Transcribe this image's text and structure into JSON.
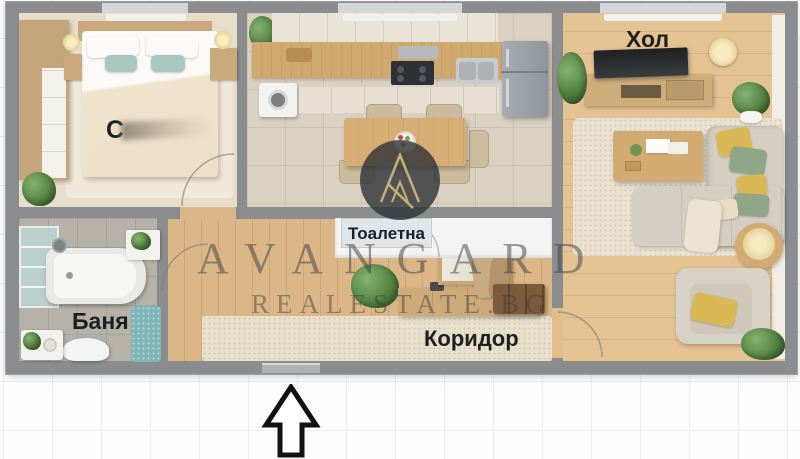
{
  "floorplan": {
    "rooms": {
      "bedroom_label": "С",
      "living_label": "Хол",
      "toilet_label": "Тоалетна",
      "bathroom_label": "Баня",
      "corridor_label": "Коридор"
    },
    "watermark": {
      "brand": "AVANGARD",
      "site": "REALESTATE.BG"
    },
    "colors": {
      "wall_gray": "#8b8c8e",
      "corridor_wood": "#dbb687",
      "living_wood": "#e5c292",
      "kitchen_tile": "#dad1c3",
      "bath_tile": "#b6b1a9",
      "bedroom_carpet": "#e8ddcb",
      "rug_beige": "#e8dfcd",
      "accent_teal": "#a9c7bf",
      "accent_yellow": "#d9b855",
      "accent_green": "#8fa688",
      "watermark_dark": "#3a3e42",
      "logo_tan": "#c8ad7a"
    }
  }
}
